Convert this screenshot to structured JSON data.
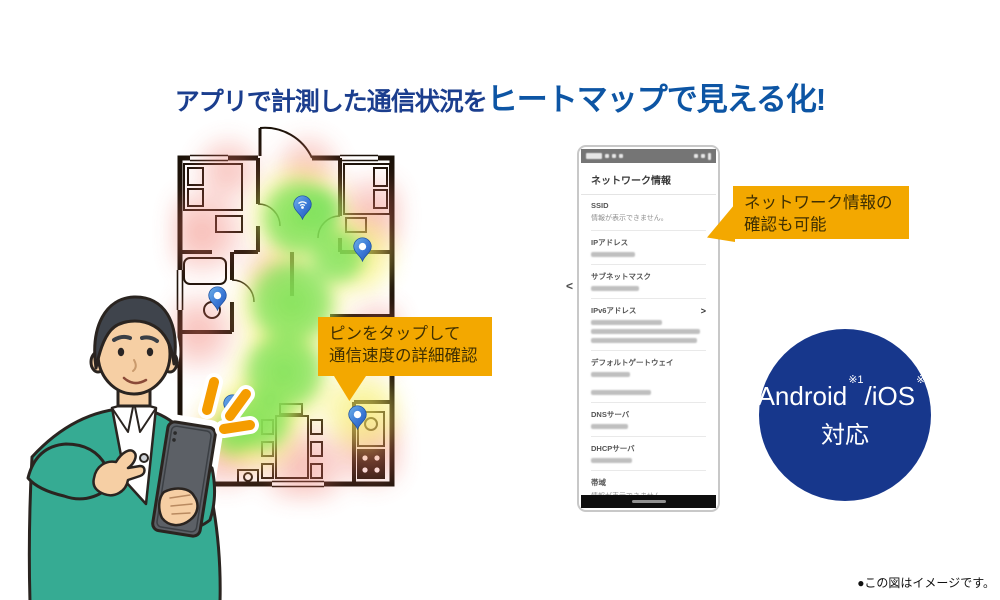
{
  "title": {
    "lead": "アプリで計測した通信状況を",
    "highlight": "ヒートマップで見える化!"
  },
  "callout_pin": {
    "line1": "ピンをタップして",
    "line2": "通信速度の詳細確認"
  },
  "callout_network": {
    "line1": "ネットワーク情報の",
    "line2": "確認も可能"
  },
  "floorplan": {
    "pins": [
      {
        "kind": "router",
        "icon": "wifi",
        "x": 130,
        "y": 84
      },
      {
        "kind": "measure",
        "icon": "dot",
        "x": 190,
        "y": 126
      },
      {
        "kind": "measure",
        "icon": "dot",
        "x": 45,
        "y": 175
      },
      {
        "kind": "measure",
        "icon": "dot",
        "x": 185,
        "y": 294
      },
      {
        "kind": "measure",
        "icon": "dot",
        "x": 60,
        "y": 283
      }
    ]
  },
  "phone": {
    "app_title": "ネットワーク情報",
    "carousel_left": "<",
    "fields": [
      {
        "label": "SSID",
        "value": "情報が表示できません。"
      },
      {
        "label": "IPアドレス",
        "masked": [
          38
        ]
      },
      {
        "label": "サブネットマスク",
        "masked": [
          42
        ]
      },
      {
        "label": "IPv6アドレス",
        "chevron": ">",
        "masked": [
          62,
          95,
          92
        ]
      },
      {
        "label": "デフォルトゲートウェイ",
        "masked": [
          34,
          52
        ],
        "gap": true
      },
      {
        "label": "DNSサーバ",
        "masked": [
          32
        ]
      },
      {
        "label": "DHCPサーバ",
        "masked": [
          36
        ]
      },
      {
        "label": "帯域",
        "value": "情報が表示できません。"
      },
      {
        "label": "チャネル",
        "masked": [
          16
        ]
      }
    ]
  },
  "badge": {
    "platform_a": "Android",
    "note_a": "※1",
    "platform_b": "/iOS",
    "note_b": "※2",
    "suffix": "対応"
  },
  "footnote": "●この図はイメージです。",
  "colors": {
    "accent_orange": "#F3A800",
    "title_navy": "#1B3E8E",
    "title_blue": "#0D55A4",
    "badge_blue": "#17378C",
    "pin_blue": "#2F6FD0",
    "heat_green": "#6CE054",
    "heat_yellow": "#F6EE60",
    "heat_red": "#F07669",
    "sweater_teal": "#36AB93"
  }
}
